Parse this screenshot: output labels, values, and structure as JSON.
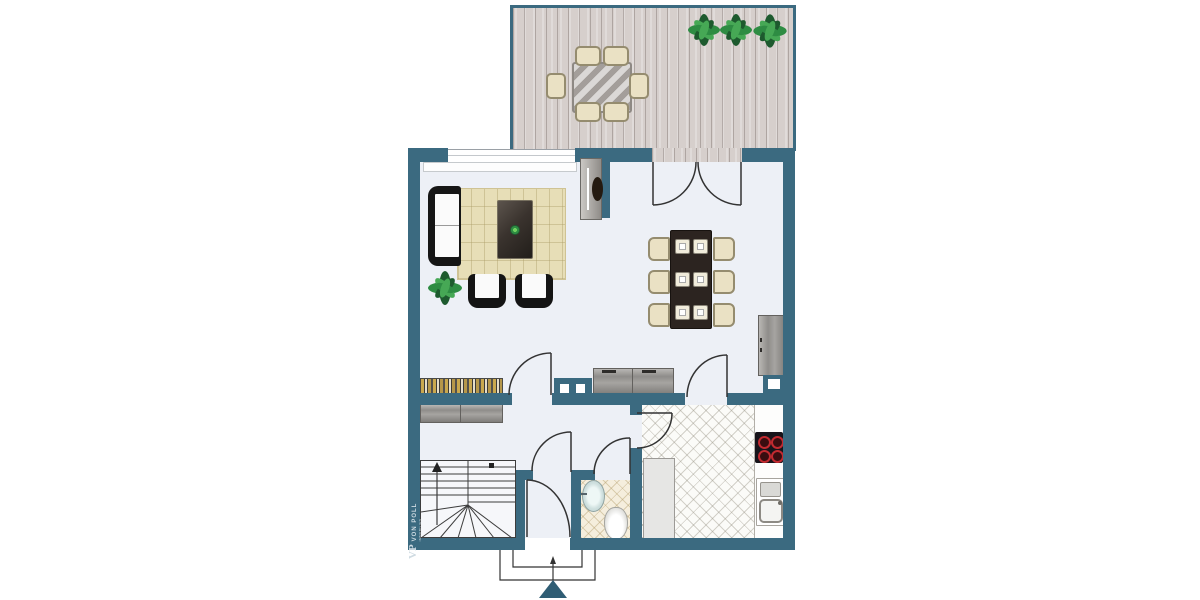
{
  "meta": {
    "image_type": "architectural floor plan, top view",
    "visible_text_count": 1
  },
  "branding": {
    "logo_monogram": "VP",
    "logo_name": "VON POLL",
    "logo_subtitle": "IMMOBILIEN"
  },
  "palette": {
    "wall_teal": "#3b6a80",
    "interior_floor": "#edf0f6",
    "terrace_deck": "#d6cfcc",
    "rug_beige": "#e7deb7",
    "furniture_black": "#161616",
    "furniture_cream": "#eae1c4",
    "cabinet_gray": "#9a9894",
    "plant_green": "#2e8c43",
    "burner_red": "#c22a30",
    "entrance_arrow_teal": "#2f5d74"
  },
  "plan": {
    "rooms": [
      "terrace",
      "living-area",
      "dining-area",
      "hallway",
      "staircase",
      "wc",
      "kitchen",
      "entrance-vestibule"
    ],
    "furniture": {
      "terrace": [
        "outdoor-dining-table",
        "six-outdoor-chairs",
        "three-plants"
      ],
      "living_area": [
        "sofa",
        "rug",
        "coffee-table-with-plant",
        "two-armchairs",
        "floor-plant",
        "tv-panel-on-wall-stub",
        "bookshelf",
        "sideboard"
      ],
      "dining_area": [
        "dining-table-with-six-place-settings",
        "six-chairs",
        "tall-sideboard",
        "lowboard"
      ],
      "hallway": [
        "sideboard"
      ],
      "kitchen": [
        "tall-cabinet",
        "countertop",
        "cooktop-four-burners",
        "kitchen-sink"
      ],
      "wc": [
        "washbasin",
        "toilet"
      ]
    },
    "doors": [
      "terrace-french-double-door",
      "living-room-door",
      "dining-to-kitchen-door",
      "hall-to-kitchen-door",
      "wc-door",
      "hall-to-vestibule-door",
      "front-entrance-door"
    ],
    "windows": [
      "living-room-window"
    ],
    "stairs": {
      "flights": 2,
      "direction_marker": "up-arrow"
    },
    "entrance_marker": "filled-arrow-pointing-into-house"
  }
}
